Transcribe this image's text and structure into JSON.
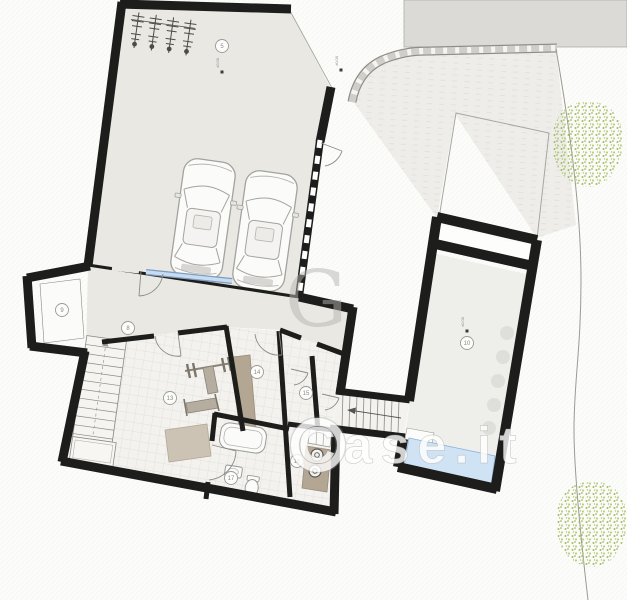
{
  "watermark": {
    "logo_letter": "G",
    "site_text": "Case.it"
  },
  "room_tags": [
    {
      "tag": "5"
    },
    {
      "tag": "9"
    },
    {
      "tag": "8"
    },
    {
      "tag": "13"
    },
    {
      "tag": "14"
    },
    {
      "tag": "15"
    },
    {
      "tag": "16"
    },
    {
      "tag": "17"
    },
    {
      "tag": "10"
    }
  ],
  "elevation_markers": [
    {
      "text": "±0.00"
    },
    {
      "text": "±0.00"
    },
    {
      "text": "±0.00"
    }
  ],
  "colors": {
    "wall": "#1d1d1b",
    "window": "#c7dcf2",
    "window_frame": "#7d9cbd",
    "pool_water": "#cfe3f5",
    "floor": "#e9e8e3",
    "tile_floor": "#f3f2ee",
    "driveway": "#eeede9",
    "furniture": "#b3a693",
    "mat": "#ccc3b4",
    "greenery": "#9cb85a",
    "neighbor_building": "#dbdad7",
    "stone_wall": "#c9c7c2"
  }
}
